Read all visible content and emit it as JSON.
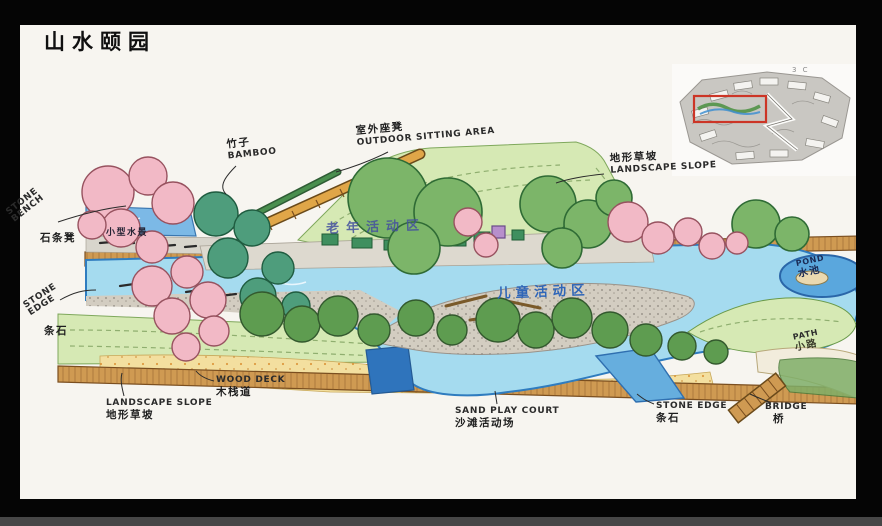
{
  "page": {
    "title": "山水颐园"
  },
  "inset": {
    "note": "3 C"
  },
  "zones": {
    "elderly": "老年活动区",
    "children": "儿童活动区"
  },
  "labels": {
    "bamboo": {
      "zh": "竹子",
      "en": "BAMBOO"
    },
    "outdoor_sitting": {
      "zh": "室外座凳",
      "en": "OUTDOOR SITTING AREA"
    },
    "slope_top": {
      "zh": "地形草坡",
      "en": "LANDSCAPE SLOPE"
    },
    "stone_bench": {
      "zh": "石条凳",
      "en": "STONE BENCH"
    },
    "water_feature": {
      "zh": "小型水景"
    },
    "stone_edge_left": {
      "zh": "条石",
      "en": "STONE EDGE"
    },
    "pond": {
      "zh": "水池",
      "en": "POND"
    },
    "path": {
      "zh": "小路",
      "en": "PATH"
    },
    "slope_bottom": {
      "zh": "地形草坡",
      "en": "LANDSCAPE SLOPE"
    },
    "wood_deck": {
      "zh": "木栈道",
      "en": "WOOD DECK"
    },
    "sand_play": {
      "zh": "沙滩活动场",
      "en": "SAND PLAY COURT"
    },
    "stone_edge_bottom": {
      "zh": "条石",
      "en": "STONE EDGE"
    },
    "bridge": {
      "zh": "桥",
      "en": "BRIDGE"
    }
  },
  "colors": {
    "lawn": "#d6e9b4",
    "river": "#a5dbef",
    "riverEdge": "#2f7cbf",
    "pond": "#5aa7dd",
    "pondDeep": "#2f74bc",
    "gravel": "#d3cdc1",
    "sand": "#f3df9f",
    "wood": "#cf9a52",
    "woodEdge": "#7a4e1f",
    "pinkTree": "#f2b9c6",
    "greenTree": "#7cb569",
    "tealTree": "#4e9d7c",
    "oliveTree": "#5e9c50",
    "purple": "#b78fcc",
    "structure": "#3f8f5f",
    "highlight": "#cc3526",
    "zoneText": "#44519e"
  }
}
